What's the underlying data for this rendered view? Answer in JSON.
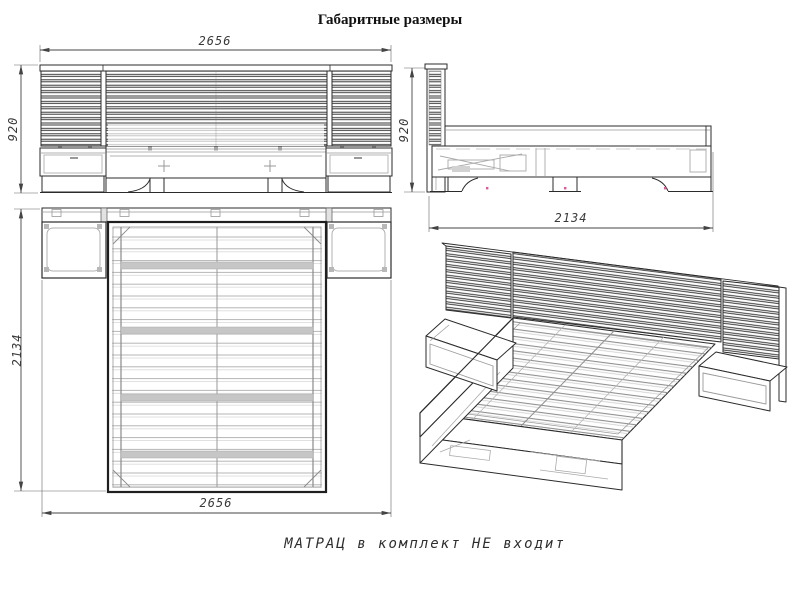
{
  "title": "Габаритные размеры",
  "note": "МАТРАЦ в комплект НЕ входит",
  "dimensions": {
    "front_width": "2656",
    "front_height": "920",
    "side_height": "920",
    "side_length": "2134",
    "top_length": "2134",
    "top_width": "2656"
  },
  "colors": {
    "background": "#ffffff",
    "line": "#2b2b2b",
    "light_line": "#b0b0b0",
    "dim_text": "#3a3a3a",
    "snap_mark": "#e0569a"
  }
}
